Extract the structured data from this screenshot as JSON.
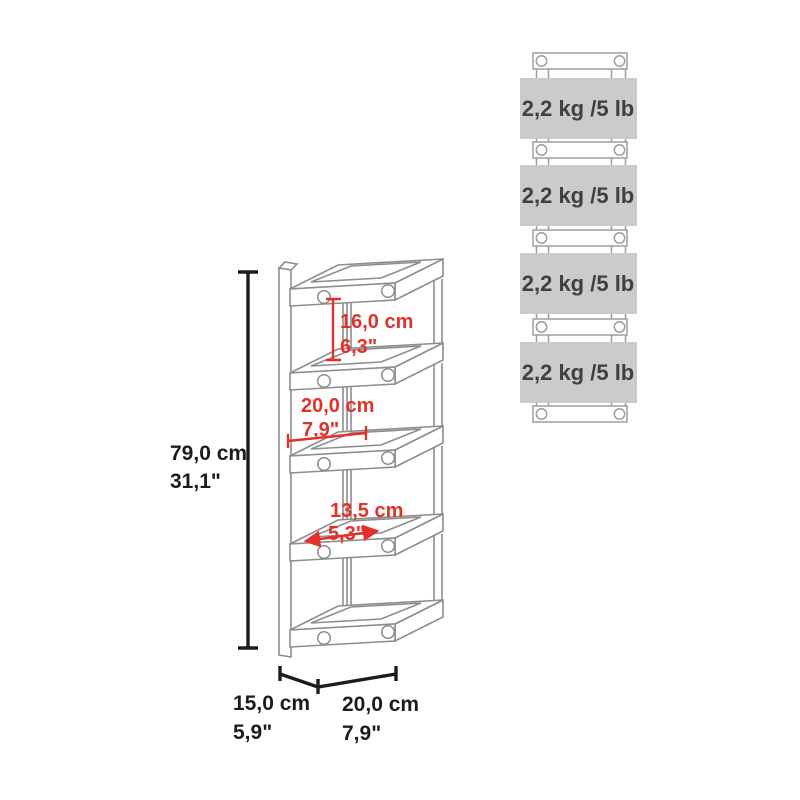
{
  "diagram": {
    "kind": "product dimension diagram",
    "views": {
      "left": "isometric line drawing of 4-tier wall-mounted rack with dimensions",
      "right": "front view of rack with per-shelf weight capacity plates"
    }
  },
  "dimensions": {
    "overall_height": {
      "cm": "79,0 cm",
      "in": "31,1\""
    },
    "top_compartment_height": {
      "cm": "16,0 cm",
      "in": "6,3\""
    },
    "inner_width": {
      "cm": "20,0 cm",
      "in": "7,9\""
    },
    "inner_depth": {
      "cm": "13,5 cm",
      "in": "5,3\""
    },
    "base_depth": {
      "cm": "15,0 cm",
      "in": "5,9\""
    },
    "base_width": {
      "cm": "20,0 cm",
      "in": "7,9\""
    }
  },
  "weights": {
    "shelves": [
      {
        "label": "2,2 kg /5 lb"
      },
      {
        "label": "2,2 kg /5 lb"
      },
      {
        "label": "2,2 kg /5 lb"
      },
      {
        "label": "2,2 kg /5 lb"
      }
    ]
  },
  "colors": {
    "dimension_black": "#1c1c1c",
    "dimension_red": "#e1322a",
    "drawing_line_gray": "#8d8d8d",
    "rack_line_gray": "#9e9e9e",
    "plate_gray": "#cbcbcb",
    "weight_text": "#404040"
  }
}
